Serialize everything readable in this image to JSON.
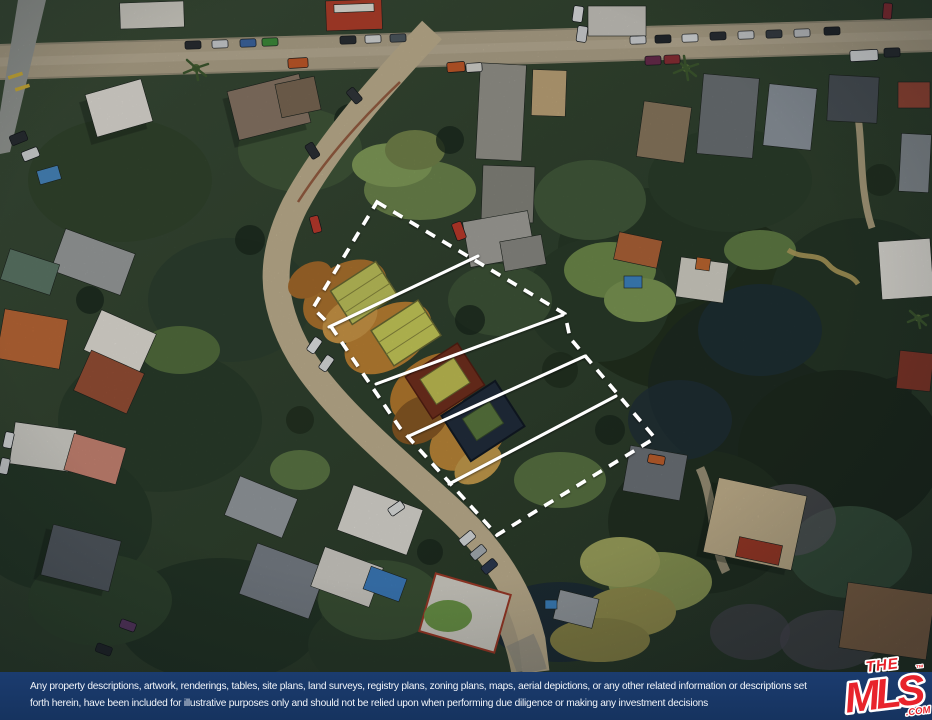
{
  "footer": {
    "disclaimer_line1": "Any property descriptions, artwork, renderings, tables, site plans, land surveys, registry plans, zoning plans, maps, aerial depictions, or any other related information or descriptions set",
    "disclaimer_line2": "forth herein, have been included for illustrative purposes only and should not be relied upon when performing due diligence or making any investment decisions",
    "background_color": "#19386b",
    "text_color": "#f2f5fa"
  },
  "logo": {
    "brand_top": "THE",
    "brand_main": "MLS",
    "trademark": "™",
    "suffix": ".COM",
    "color": "#e8232b"
  },
  "map": {
    "type": "aerial-satellite-photo",
    "overlay": {
      "boundary_style": "white-dashed-polygon",
      "lot_divider_lines": 4,
      "lots_outlined": 5
    }
  }
}
